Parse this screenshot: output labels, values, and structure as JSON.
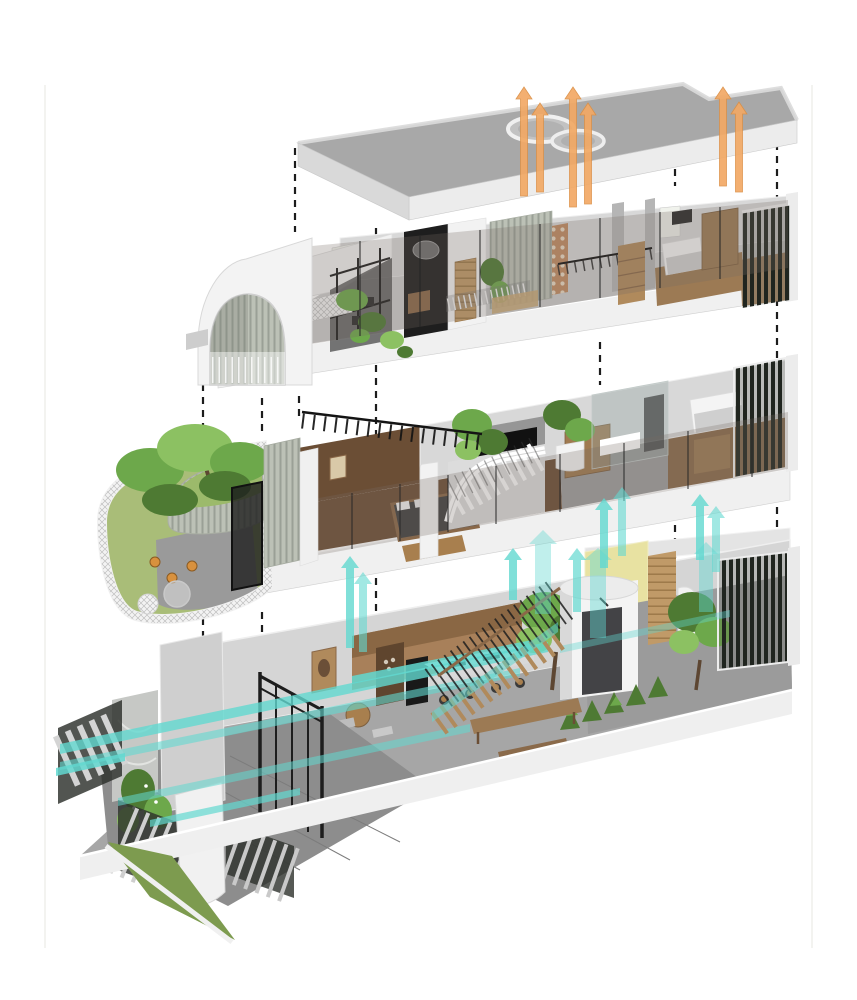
{
  "scene": {
    "description": "Exploded axonometric diagram of a narrow tube house: detached roof slab with twin circular skylights, a second floor with barrel vault, a first floor with curved planted balcony, and a ground floor with gated entry court; levels linked by dashed alignment lines and airflow arrows",
    "levels": [
      {
        "id": "roof",
        "aria": "roof slab with circular skylights and orange exhaust-air arrows"
      },
      {
        "id": "second-floor",
        "aria": "second floor with barrel-vaulted room, mesh terrace, stair void and bedroom"
      },
      {
        "id": "first-floor",
        "aria": "first floor with curved planted balcony, master bedroom, central white staircase and glass bathroom"
      },
      {
        "id": "ground-floor",
        "aria": "ground floor with slatted entry fence, kitchen, open timber stair and rear garden court"
      }
    ],
    "airflow": {
      "exhaust": {
        "color_key": "orange",
        "direction": "up",
        "arrow_count": 6
      },
      "cross_ventilation": {
        "color_key": "teal",
        "direction": "through and up",
        "arrow_count": 11
      }
    },
    "alignment_lines": {
      "style": "dashed",
      "count": 8
    }
  },
  "colors": {
    "bg": "#ffffff",
    "margin_line": "#efefec",
    "dash": "#1c1c1c",
    "concrete_top": "#a8a8a8",
    "concrete_face": "#ececec",
    "concrete_side": "#d9d9d9",
    "wall_light": "#d8d8d8",
    "wall_mid": "#b5b5b5",
    "wall_dark": "#8f8f8f",
    "glass_tint": "rgba(118,108,100,0.27)",
    "glass_cool": "rgba(150,165,162,0.38)",
    "wood_dark": "#6b4e35",
    "wood_mid": "#9c7a54",
    "wood_light": "#c09a68",
    "wood_kitchen": "#a8805a",
    "grass": "#7d9b4f",
    "grass_light": "#a9bd78",
    "foliage": "#6da84b",
    "foliage_dark": "#4e7a33",
    "foliage_light": "#8cc162",
    "trunk": "#5d4632",
    "orange": "#f2a965",
    "orange_dark": "#db8f45",
    "teal": "#62d8d0",
    "teal_light": "#a9ece6",
    "yellow_wall": "#e8e2a2",
    "metal_dark": "#232323",
    "screen_dark": "#20251f",
    "slat_bg": "#bcc1b6",
    "slat_line": "#9aa096",
    "paver": "#8d8d8d",
    "white_paint": "#f2f2f2",
    "lattice_clay": "#c08b62"
  }
}
